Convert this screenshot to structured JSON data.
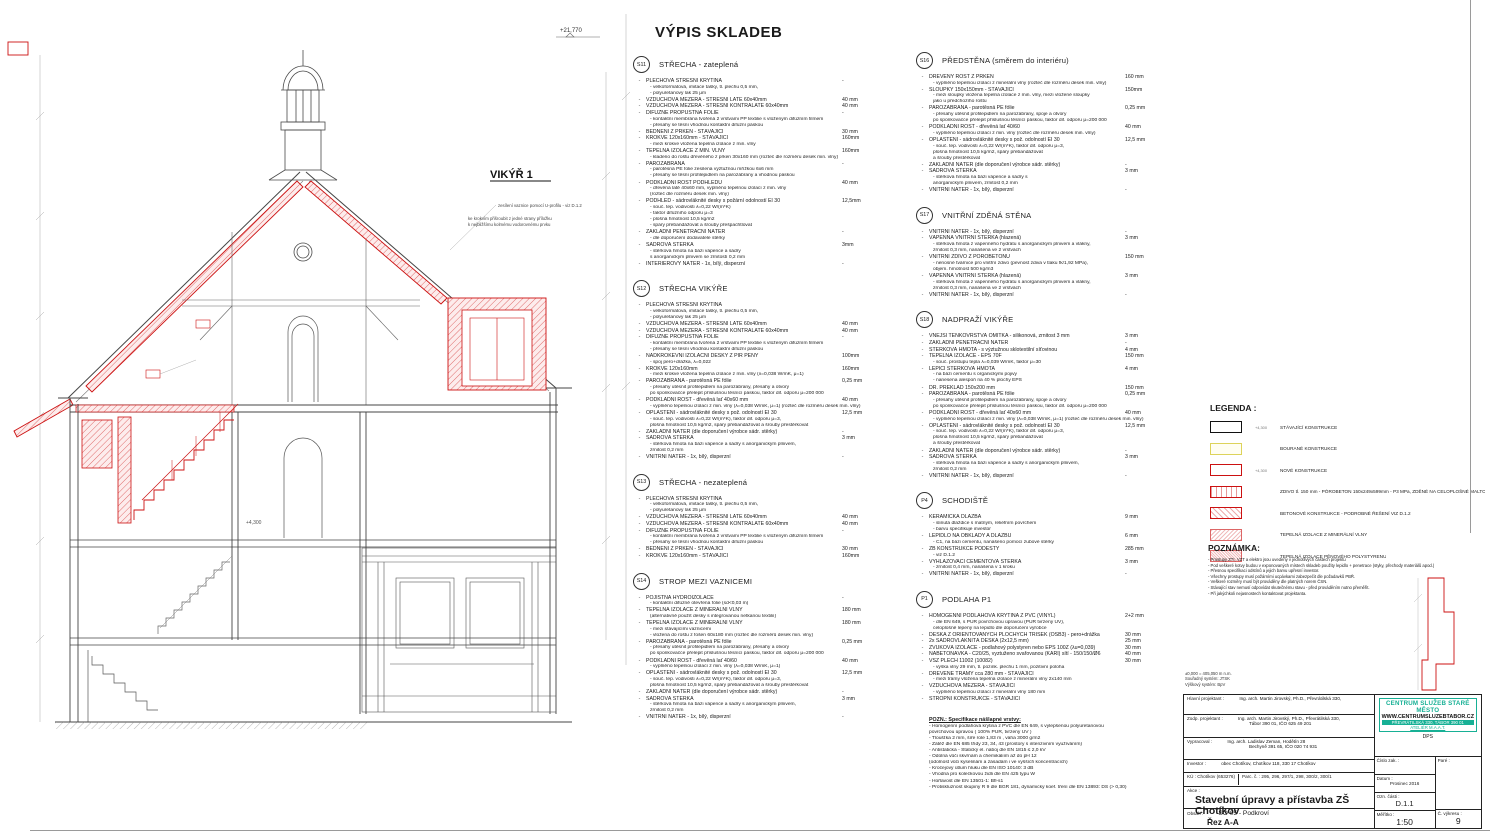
{
  "sheet": {
    "main_title": "VÝPIS SKLADEB"
  },
  "drawing": {
    "vikyr_label": "VIKÝŘ 1",
    "elevation_top": "+21,770",
    "elevation_mid": "+4,300",
    "note1": "zesílení vaznice pomocí U-profilu - viz D.1.2",
    "note2": "ke krokvím přišroubit z jedné strany příložku",
    "note3": "k nejbližšímu kolmému vodorovnému prvku"
  },
  "sections_col1": [
    {
      "id": "S11",
      "name": "STŘECHA - zateplená",
      "items": [
        {
          "l": "PLECHOVÁ STŘEŠNÍ KRYTINA",
          "v": "-",
          "s": [
            "- velkoformátová, imitace tašky, tl. plechu 0,5 mm,",
            "- polyuretanový lak 25 μm"
          ]
        },
        {
          "l": "VZDUCHOVÁ MEZERA - STŘEŠNÍ LATĚ 60x40mm",
          "v": "40 mm"
        },
        {
          "l": "VZDUCHOVÁ MEZERA - STŘEŠNÍ KONTRALATĚ 60x40mm",
          "v": "40 mm"
        },
        {
          "l": "DIFÚZNĚ PROPUSTNÁ FOLIE",
          "v": "-",
          "s": [
            "- kontaktní membrána tvořená 2 vrstvami PP textilie s vloženým difúzním filmem",
            "- přesahy se těsní vhodnou kontaktní difúzní páskou"
          ]
        },
        {
          "l": "BEDNĚNÍ Z PRKEN - STÁVAJÍCÍ",
          "v": "30 mm"
        },
        {
          "l": "KROKVE 120x160mm - STÁVAJÍCÍ",
          "v": "160mm",
          "s": [
            "- mezi krokve vložena tepelná izolace z min. vlny"
          ]
        },
        {
          "l": "TEPELNÁ IZOLACE Z MIN. VLNY",
          "v": "160mm",
          "s": [
            "- kladeno do roštu dřevěného z prken 30x160 mm (rozteč dle rozměru desek min. vlny)"
          ]
        },
        {
          "l": "PAROZÁBRANA",
          "v": "-",
          "s": [
            "- parotěsná PE folie zesílená výztužnou mřížkou 6x6 mm",
            "- přesahy se těsní profilepidlem na parozábrany a vhodnou páskou"
          ]
        },
        {
          "l": "PODKLADNÍ ROŠT PODHLEDU",
          "v": "40 mm",
          "s": [
            "- dřevěná latě 40x60 mm, vyplněno tepelnou izolací z min. vlny",
            "(rozteč dle rozměru desek min. vlny)"
          ]
        },
        {
          "l": "PODHLED - sádrovláknité desky s požární odolností EI 30",
          "v": "12,5mm",
          "s": [
            "- souč. tep. vodivosti λ=0,22 W/(m*K)",
            "- faktor difúzního odporu μ=3",
            "- plošná hmotnost 10,5 kg/m2",
            "- spáry přebandážovat a šrouby přešpachtlovat"
          ]
        },
        {
          "l": "ZÁKLADNÍ PENETRAČNÍ NÁTĚR",
          "v": "-",
          "s": [
            "- dle doporučení dodavatele stěrky"
          ]
        },
        {
          "l": "SÁDROVÁ STĚRKA",
          "v": "3mm",
          "s": [
            "- stěrková hmota na bázi vápence a sádry",
            "s anorganickým plnivem se zrnitostí 0,2 mm"
          ]
        },
        {
          "l": "INTERIÉROVÝ NÁTĚR - 1x, bílý, disperzní",
          "v": "-"
        }
      ]
    },
    {
      "id": "S12",
      "name": "STŘECHA VIKÝŘE",
      "items": [
        {
          "l": "PLECHOVÁ STŘEŠNÍ KRYTINA",
          "v": "",
          "s": [
            "- velkoformátová, imitace tašky, tl. plechu 0,5 mm,",
            "- polyuretanový lak 25 μm"
          ]
        },
        {
          "l": "VZDUCHOVÁ MEZERA - STŘEŠNÍ LATĚ 60x40mm",
          "v": "40 mm"
        },
        {
          "l": "VZDUCHOVÁ MEZERA - STŘEŠNÍ KONTRALATĚ 60x40mm",
          "v": "40 mm"
        },
        {
          "l": "DIFÚZNĚ PROPUSTNÁ FOLIE",
          "v": "-",
          "s": [
            "- kontaktní membrána tvořená 2 vrstvami PP textilie s vloženým difúzním filmem",
            "- přesahy se těsní vhodnou kontaktní difúzní páskou"
          ]
        },
        {
          "l": "NADKROKEVNÍ IZOLAČNÍ DESKY Z PIR PĚNY",
          "v": "100mm",
          "s": [
            "- spoj pero+drážka, λ=0,022"
          ]
        },
        {
          "l": "KROKVE 120x160mm",
          "v": "160mm",
          "s": [
            "- mezi krokve vložena tepelná izolace z min. vlny (λ=0,038 W/mK, μ=1)"
          ]
        },
        {
          "l": "PAROZÁBRANA - parotěsná PE fólie",
          "v": "0,25 mm",
          "s": [
            "- přesahy utěsnit profilepidlem na parozábrany, přesahy a otvory",
            "po sponkovačce přelepit příslušnou těsnící páskou,  faktor dif. odporu μ=200 000"
          ]
        },
        {
          "l": "PODKLADNÍ ROŠT - dřevěná lať 40x60 mm",
          "v": "40 mm",
          "s": [
            "- vyplněno tepelnou izolací z min. vlny (λ=0,038 W/mK, μ=1) (rozteč dle rozměru desek min. vlny)"
          ]
        },
        {
          "l": "OPLÁŠTĚNÍ - sádrovláknité desky s pož. odolností EI 30",
          "v": "12,5 mm",
          "s": [
            "- souč. tep. vodivosti λ=0,22 W/(m*K), faktor dif. odporu μ=3,",
            "plošná hmotnost 10,5 kg/m2, spáry přebandážovat a šrouby přestěrkovat"
          ]
        },
        {
          "l": "ZÁKLADNÍ NÁTĚR (dle doporučení výrobce sádr. stěrky)",
          "v": "-"
        },
        {
          "l": "SÁDROVÁ STĚRKA",
          "v": "3 mm",
          "s": [
            "- stěrková hmota na bázi vápence a sádry s anorganickým plnivem,",
            "zrnitost 0,2 mm"
          ]
        },
        {
          "l": "VNITŘNÍ NÁTĚR - 1x, bílý, disperzní",
          "v": "-"
        }
      ]
    },
    {
      "id": "S13",
      "name": "STŘECHA - nezateplená",
      "items": [
        {
          "l": "PLECHOVÁ STŘEŠNÍ KRYTINA",
          "v": "",
          "s": [
            "- velkoformátová, imitace tašky, tl. plechu 0,5 mm,",
            "- polyuretanový lak 25 μm"
          ]
        },
        {
          "l": "VZDUCHOVÁ MEZERA - STŘEŠNÍ LATĚ 60x40mm",
          "v": "40 mm"
        },
        {
          "l": "VZDUCHOVÁ MEZERA - STŘEŠNÍ KONTRALATĚ 60x40mm",
          "v": "40 mm"
        },
        {
          "l": "DIFÚZNĚ PROPUSTNÁ FOLIE",
          "v": "-",
          "s": [
            "- kontaktní membrána tvořená 2 vrstvami PP textilie s vloženým difúzním filmem",
            "- přesahy se těsní vhodnou kontaktní difúzní páskou"
          ]
        },
        {
          "l": "BEDNĚNÍ Z PRKEN - STÁVAJÍCÍ",
          "v": "30 mm"
        },
        {
          "l": "KROKVE 120x160mm - STÁVAJÍCÍ",
          "v": "160mm"
        }
      ]
    },
    {
      "id": "S14",
      "name": "STROP MEZI VAZNICEMI",
      "items": [
        {
          "l": "POJISTNÁ HYDROIZOLACE",
          "v": "-",
          "s": [
            "- kontaktní difúzně otevřená fólie (sd<0,03 m)"
          ]
        },
        {
          "l": "TEPELNÁ IZOLACE Z MINERÁLNÍ VLNY",
          "v": "180 mm",
          "s": [
            "(alternativně použít desky s integrovanou netkanou textilií)"
          ]
        },
        {
          "l": "TEPELNÁ IZOLACE Z MINERÁLNÍ VLNY",
          "v": "180 mm",
          "s": [
            "- mezi stávajícími vaznicemi",
            "- vložená do roštu z fošen 60x180 mm (rozteč dle rozměrů desek min. vlny)"
          ]
        },
        {
          "l": "PAROZÁBRANA - parotěsná PE fólie",
          "v": "0,25 mm",
          "s": [
            "- přesahy utěsnit profilepidlem na parozábrany, přesahy a otvory",
            "po sponkovačce přelepit příslušnou těsnící páskou,  faktor dif. odporu μ=200 000"
          ]
        },
        {
          "l": "PODKLADNÍ ROŠT - dřevěná lať 40/60",
          "v": "40 mm",
          "s": [
            "- vyplněno tepelnou izolací z min. vlny (λ=0,038 W/mK, μ=1)"
          ]
        },
        {
          "l": "OPLÁŠTĚNÍ - sádrovláknité desky s pož. odolností EI 30",
          "v": "12,5 mm",
          "s": [
            "- souč. tep. vodivosti λ=0,22 W/(m*K), faktor dif. odporu μ=3,",
            "plošná hmotnost 10,5 kg/m2, spáry přebandážovat a šrouby přestěrkovat"
          ]
        },
        {
          "l": "ZÁKLADNÍ NÁTĚR (dle doporučení výrobce sádr. stěrky)",
          "v": "-"
        },
        {
          "l": "SÁDROVÁ STĚRKA",
          "v": "3 mm",
          "s": [
            "- stěrková hmota na bázi vápence a sádry s anorganickým plnivem,",
            "zrnitost 0,2 mm"
          ]
        },
        {
          "l": "VNITŘNÍ NÁTĚR - 1x, bílý, disperzní",
          "v": "-"
        }
      ]
    }
  ],
  "sections_col2": [
    {
      "id": "S16",
      "name": "PŘEDSTĚNA (směrem do interiéru)",
      "items": [
        {
          "l": "DŘEVĚNÝ ROŠT Z PRKEN",
          "v": "160 mm",
          "s": [
            "- vyplněno tepelnou izolací z minerální vlny (rozteč dle rozměru desek min. vlny)"
          ]
        },
        {
          "l": "SLOUPKY 150x150mm - STÁVAJÍCÍ",
          "v": "150mm",
          "s": [
            "- mezi sloupky vložena tepelná izolace z min. vlny, mezi vložené sloupky",
            "jako u předchozího roštu"
          ]
        },
        {
          "l": "PAROZÁBRANA - parotěsná PE fólie",
          "v": "0,25 mm",
          "s": [
            "- přesahy utěsnit profilepidlem na parozábrany, spoje a otvory",
            "po sponkovačce přelepit příslušnou těsnící páskou,  faktor dif. odporu μ=200 000"
          ]
        },
        {
          "l": "PODKLADNÍ ROŠT - dřevěná lať 40/60",
          "v": "40 mm",
          "s": [
            "- vyplněno tepelnou izolací z min. vlny (rozteč dle rozměru desek min. vlny)"
          ]
        },
        {
          "l": "OPLÁŠTĚNÍ - sádrovláknité desky s pož. odolností EI 30",
          "v": "12,5 mm",
          "s": [
            "- souč. tep. vodivosti λ=0,22 W/(m*K), faktor dif. odporu μ=3,",
            "plošná hmotnost 10,5 kg/m2, spáry přebandážovat",
            "a šrouby přestěrkovat"
          ]
        },
        {
          "l": "ZÁKLADNÍ NÁTĚR (dle doporučení výrobce sádr. stěrky)",
          "v": "-"
        },
        {
          "l": "SÁDROVÁ STĚRKA",
          "v": "3 mm",
          "s": [
            "- stěrková hmota na bázi vápence a sádry s",
            "anorganickým plnivem, zrnitost 0,2 mm"
          ]
        },
        {
          "l": "VNITŘNÍ NÁTĚR - 1x, bílý, disperzní",
          "v": "-"
        }
      ]
    },
    {
      "id": "S17",
      "name": "VNITŘNÍ ZDĚNÁ STĚNA",
      "items": [
        {
          "l": "VNITŘNÍ NÁTĚR - 1x, bílý, disperzní",
          "v": "-"
        },
        {
          "l": "VÁPENNÁ VNITŘNÍ STĚRKA (hlazená)",
          "v": "3 mm",
          "s": [
            "- stěrková hmota z vápenného hydrátu s anorganickým plnivem a vlákny,",
            "zrnitost 0,3 mm, nanášená ve 2 vrstvách"
          ]
        },
        {
          "l": "VNITŘNÍ ZDIVO Z PÓROBETONU",
          "v": "150 mm",
          "s": [
            "- nenosné tvárnice pro vnitřní zdivo (pevnost zdiva v tlaku fk/1,92 MPa),",
            "objem. hmotnost 500 kg/m3"
          ]
        },
        {
          "l": "VÁPENNÁ VNITŘNÍ STĚRKA (hlazená)",
          "v": "3 mm",
          "s": [
            "- stěrková hmota z vápenného hydrátu s anorganickým plnivem a vlákny,",
            "zrnitost 0,3 mm, nanášená ve 2 vrstvách"
          ]
        },
        {
          "l": "VNITŘNÍ NÁTĚR - 1x, bílý, disperzní",
          "v": "-"
        }
      ]
    },
    {
      "id": "S18",
      "name": "NADPRAŽÍ VIKÝŘE",
      "items": [
        {
          "l": "VNĚJŠÍ TENKOVRSTVÁ OMÍTKA - silikonová, zrnitost 3 mm",
          "v": "3 mm"
        },
        {
          "l": "ZÁKLADNÍ PENETRAČNÍ NÁTĚR",
          "v": "-"
        },
        {
          "l": "STĚRKOVÁ HMOTA - s výztužnou sklotextilní síťovinou",
          "v": "4 mm"
        },
        {
          "l": "TEPELNÁ IZOLACE - EPS 70F",
          "v": "150 mm",
          "s": [
            "- souč. prostupu tepla λ=0,039 W/mK, faktor μ=30"
          ]
        },
        {
          "l": "LEPÍCÍ STĚRKOVÁ HMOTA",
          "v": "4 mm",
          "s": [
            "- na bázi cementu s organickými pojivy",
            "- nanesena alespoň na 40 % plochy EPS"
          ]
        },
        {
          "l": "DŘ. PŘEKLAD 150x200 mm",
          "v": "150 mm"
        },
        {
          "l": "PAROZÁBRANA - parotěsná PE fólie",
          "v": "0,25 mm",
          "s": [
            "- přesahy utěsnit profilepidlem na parozábrany, spoje a otvory",
            "po sponkovačce přelepit příslušnou těsnící páskou,  faktor dif. odporu μ=200 000"
          ]
        },
        {
          "l": "PODKLADNÍ ROŠT - dřevěná lať 40x60 mm",
          "v": "40 mm",
          "s": [
            "- vyplněno tepelnou izolací z min. vlny (λ=0,038 W/mK, μ=1) (rozteč dle rozměru desek min. vlny)"
          ]
        },
        {
          "l": "OPLÁŠTĚNÍ - sádrovláknité desky s pož. odolností EI 30",
          "v": "12,5 mm",
          "s": [
            "- souč. tep. vodivosti λ=0,22 W/(m*K), faktor dif. odporu μ=3,",
            "plošná hmotnost 10,5 kg/m2, spáry přebandážovat",
            "a šrouby přestěrkovat"
          ]
        },
        {
          "l": "ZÁKLADNÍ NÁTĚR (dle doporučení výrobce sádr. stěrky)",
          "v": "-"
        },
        {
          "l": "SÁDROVÁ STĚRKA",
          "v": "3 mm",
          "s": [
            "- stěrková hmota na bázi vápence a sádry s anorganickým plnivem,",
            "zrnitost 0,2 mm"
          ]
        },
        {
          "l": "VNITŘNÍ NÁTĚR - 1x, bílý, disperzní",
          "v": "-"
        }
      ]
    },
    {
      "id": "P4",
      "name": "SCHODIŠTĚ",
      "items": [
        {
          "l": "KERAMICKÁ DLAŽBA",
          "v": "9 mm",
          "s": [
            "- slinutá dlaždice s matným, reliéfním povrchem",
            "- barvu specifikuje investor"
          ]
        },
        {
          "l": "LEPIDLO NA OBKLADY A DLAŽBU",
          "v": "6 mm",
          "s": [
            "- C1, na bázi cementu, nanášeno pomocí zubové stěrky"
          ]
        },
        {
          "l": "ŽB KONSTRUKCE PODESTY",
          "v": "285 mm",
          "s": [
            "- viz D.1.2"
          ]
        },
        {
          "l": "VYHLAZOVACÍ CEMENTOVÁ STĚRKA",
          "v": "3 mm",
          "s": [
            "- zrnitost 0,4 mm, nanášená v 1 kroku"
          ]
        },
        {
          "l": "VNITŘNÍ NÁTĚR - 1x, bílý, disperzní",
          "v": "-"
        }
      ]
    },
    {
      "id": "P1",
      "name": "PODLAHA P1",
      "items": [
        {
          "l": "HOMOGENNÍ PODLAHOVÁ KRYTINA Z PVC (VINYL)",
          "v": "2+2 mm",
          "s": [
            "- dle EN 649, s PUR povrchovou úpravou (PUR tvrzený UV),",
            "celoplošně lepený na lepidlo dle doporučení výrobce"
          ]
        },
        {
          "l": "DESKA Z ORIENTOVANÝCH PLOCHÝCH TŘÍSEK (OSB3) - pero+drážka",
          "v": "30 mm"
        },
        {
          "l": "2x SÁDROVLÁKNITÁ DESKA (2x12,5 mm)",
          "v": "25 mm"
        },
        {
          "l": "ZVUKOVÁ IZOLACE - podlahový polystyren nebo EPS 100Z (λu=0,039)",
          "v": "30 mm"
        },
        {
          "l": "NABETONÁVKA - C20/25, vyztuženo svařovanou (KARI) sítí - 150/150/Ø6",
          "v": "40 mm"
        },
        {
          "l": "VSŽ PLECH 11002 (10082)",
          "v": "30 mm",
          "s": [
            "- výška vlny 29 mm, tl. pozink. plechu 1 mm, pozitivní poloha"
          ]
        },
        {
          "l": "DŘEVĚNÉ TRÁMY cca 280 mm  - STÁVAJÍCÍ",
          "v": "",
          "s": [
            "- mezi trámy vložena tepelná izolace z minerální vlny 2x140 mm"
          ]
        },
        {
          "l": "VZDUCHOVÁ MEZERA - STÁVAJÍCÍ",
          "v": "",
          "s": [
            "- vyplněno tepelnou izolací z minerální vlny 180 mm"
          ]
        },
        {
          "l": "STROPNÍ KONSTRUKCE - STÁVAJÍCÍ",
          "v": ""
        }
      ]
    },
    {
      "note": "POZN.:  Specifikace nášlapné vrstvy:",
      "lines": [
        "- Homogenní podlahová krytina z PVC dle EN 649, s vylepšenou polyuretanovou",
        "  povrchovou úpravou ( 100% PUR, tvrzený UV )",
        "- Tloušťka 2 mm, šíře role 1,83 m , váha 3000 g/m2",
        "- Zátěž dle EN 685 třídy 23, 34, 43 (prostory s intenzivním využíváním)",
        "- Antistatická - Statický el. náboj dle EN 1815   ≤ 2,0 kV",
        "- Odolná vůči skvrnám a chemikáliím až do pH 12",
        "  (odolnost vůči kyselinám a zásadám i ve vyšších koncentracích)",
        "- Kročejový útlum hluku dle EN ISO 10140:   3 dB",
        "- Vhodná pro kolečkovou židli dle EN 425 typu W",
        "- Hořlavost dle EN 13501-1:   Bfl-s1",
        "- Protiskluznost skupiny R 9 dle BGR 181, dynamický koef. tření dle EN 13893:  DS (> 0,30)"
      ]
    }
  ],
  "legend": {
    "title": "LEGENDA :",
    "items": [
      {
        "swatch": "existing",
        "mark": "+4,300",
        "label": "STÁVAJÍCÍ KONSTRUKCE"
      },
      {
        "swatch": "demolish",
        "mark": "",
        "label": "BOURANÉ KONSTRUKCE"
      },
      {
        "swatch": "new",
        "mark": "+4,300",
        "label": "NOVÉ KONSTRUKCE"
      },
      {
        "swatch": "aerated",
        "mark": "",
        "label": "ZDIVO tl. 150 mm - PÓROBETON 150x249x599mm - P3 MPa, ZDĚNÉ NA CELOPLOŠNÉ MALTOVÉ LOŽE 1-3mm"
      },
      {
        "swatch": "concrete",
        "mark": "",
        "label": "BETONOVÉ KONSTRUKCE - PODROBNÉ ŘEŠENÍ VIZ D.1.2"
      },
      {
        "swatch": "mw",
        "mark": "",
        "label": "TEPELNÁ IZOLACE Z MINERÁLNÍ VLNY"
      },
      {
        "swatch": "eps",
        "mark": "",
        "label": "TEPELNÁ IZOLACE PĚNOVÉHO POLYSTYRENU"
      }
    ]
  },
  "poznamka": {
    "title": "POZNÁMKA:",
    "lines": [
      "- Prostupy ZTI, VZT a elektro jsou uvedeny v jednotlivých částech projektu",
      "- Pod veškeré kotvy budou v exponovaných místech skladeb použity lepidlo + penetrace (styky, přechody materiálů apod.)",
      "- Přesnou specifikaci odstínů a jejich barvu upřesní investor.",
      "- Všechny prostupy musí požárními ucpávkami zabezpečit dle požadavků PBŘ.",
      "- Veškeré rozměry musí být prováděny dle platných norem ČSN.",
      "- Stávající stav nemusí odpovídat skutečnému stavu - před prováděním nutno přeměřit.",
      "- Při jakýchkoli nejasnostech kontaktovat projektanta."
    ]
  },
  "titleblock": {
    "over_line1": "±0,000 =      405,050 m n.m.",
    "over_line2": "Souřadný systém:      JTSK",
    "over_line3": "Výškový systém:      BpV",
    "hlavni_label": "Hlavní projektant :",
    "hlavni_value": "Ing. arch. Martin Jirovský, Ph.D., Převrátilská 330,",
    "zodp_label": "Zodp. projektant :",
    "zodp_value1": "Ing. arch. Martin Jirovský, Ph.D., Převrátilská 330,",
    "zodp_value2": "Tábor 390 01, IČO 625 49 201",
    "vypracoval_label": "Vypracoval :",
    "vypracoval_value1": "Ing. arch. Ladislav Zeman, Hodětín 28",
    "vypracoval_value2": "Bechyně 391 65, IČO 020 74 931",
    "investor_label": "Investor :",
    "investor_value": "obec Chotíkov, Chotíkov 118, 330 17 Chotíkov",
    "ku_label": "KÚ :",
    "ku_value": "Chotíkov (653276)",
    "parc_label": "Parc. č. :",
    "parc_value": "295, 296, 297/1, 298, 300/2, 300/1",
    "akce_label": "Akce :",
    "akce_value": "Stavební úpravy a přístavba ZŠ Chotíkov",
    "obsah_label": "Obsah :",
    "obsah_value": "SO 05 - Podkroví",
    "rez_value": "Řez A-A",
    "logo_line1": "CENTRUM SLUŽEB STARÉ MĚSTO",
    "logo_line2": "WWW.CENTRUMSLUZEBTABOR.CZ",
    "logo_line3": "PŘEVRÁTILSKÁ 330, TÁBOR 390 01",
    "logo_line4": "ATELIÉR M.A.A.T.",
    "logo_line5": "DPS",
    "cislo_label": "Číslo zak. :",
    "pare_label": "Paré :",
    "datum_label": "Datum :",
    "datum_value": "Prosinec 2016",
    "ozn_label": "Ozn. části :",
    "ozn_value": "D.1.1",
    "meritko_label": "Měřítko :",
    "meritko_value": "1:50",
    "vykres_label": "Č. výkresu :",
    "vykres_value": "9",
    "accent_color": "#17b095",
    "new_construction_color": "#cc1111"
  }
}
